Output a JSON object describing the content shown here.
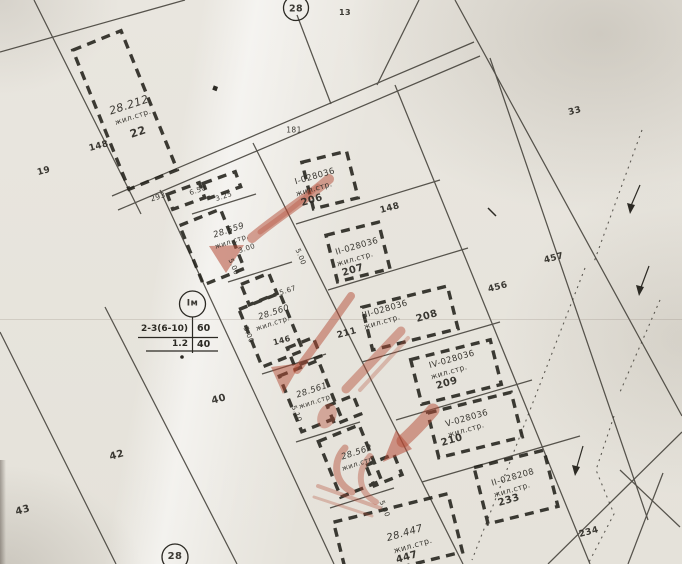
{
  "map": {
    "title_hint": "cadastral regulation plan sheet",
    "block_circle_top": "28",
    "block_circle_bottom": "28",
    "zone_box": {
      "zone": "Iм",
      "row1_left": "2-3(6-10)",
      "row1_right": "60",
      "row2_left": "1.2",
      "row2_right": "40"
    },
    "colors": {
      "paper": "#e9e6df",
      "ink": "#2c2a24",
      "red_marker": "#b44b36"
    },
    "labels": [
      {
        "n": "block-13",
        "t": "13",
        "x": 345,
        "y": 13,
        "r": 0,
        "s": 8,
        "b": true
      },
      {
        "n": "28-212",
        "t": "28.212",
        "x": 129,
        "y": 105,
        "r": -18,
        "s": 11,
        "i": true
      },
      {
        "n": "28-212-type",
        "t": "жил.стр.",
        "x": 133,
        "y": 117,
        "r": -18,
        "s": 7.5
      },
      {
        "n": "22",
        "t": "22",
        "x": 138,
        "y": 132,
        "r": -18,
        "s": 11,
        "b": true
      },
      {
        "n": "148-left",
        "t": "148",
        "x": 99,
        "y": 147,
        "r": -15,
        "s": 9,
        "b": true
      },
      {
        "n": "19",
        "t": "19",
        "x": 44,
        "y": 172,
        "r": -15,
        "s": 9,
        "b": true
      },
      {
        "n": "293",
        "t": "293",
        "x": 158,
        "y": 197,
        "r": -18,
        "s": 7.5
      },
      {
        "n": "dim-650",
        "t": "6.50",
        "x": 198,
        "y": 191,
        "r": -18,
        "s": 7
      },
      {
        "n": "dim-325",
        "t": "3.25",
        "x": 224,
        "y": 197,
        "r": -18,
        "s": 7
      },
      {
        "n": "181",
        "t": "181",
        "x": 294,
        "y": 130,
        "r": 0,
        "s": 7.5
      },
      {
        "n": "i-028036",
        "t": "I-028036",
        "x": 315,
        "y": 177,
        "r": -16,
        "s": 8.5
      },
      {
        "n": "i-028036-type",
        "t": "жил.стр.",
        "x": 314,
        "y": 189,
        "r": -16,
        "s": 7.5
      },
      {
        "n": "206",
        "t": "206",
        "x": 312,
        "y": 201,
        "r": -16,
        "s": 10,
        "b": true
      },
      {
        "n": "148-right",
        "t": "148",
        "x": 390,
        "y": 209,
        "r": -15,
        "s": 9,
        "b": true
      },
      {
        "n": "ii-028036",
        "t": "II-028036",
        "x": 357,
        "y": 247,
        "r": -16,
        "s": 8.5
      },
      {
        "n": "ii-028036-type",
        "t": "жил.стр.",
        "x": 355,
        "y": 259,
        "r": -16,
        "s": 7.5
      },
      {
        "n": "207",
        "t": "207",
        "x": 353,
        "y": 271,
        "r": -16,
        "s": 10,
        "b": true
      },
      {
        "n": "iii-028036",
        "t": "III-028036",
        "x": 385,
        "y": 310,
        "r": -16,
        "s": 8.5
      },
      {
        "n": "iii-028036-type",
        "t": "жил.стр.",
        "x": 382,
        "y": 322,
        "r": -16,
        "s": 7.5
      },
      {
        "n": "208",
        "t": "208",
        "x": 427,
        "y": 317,
        "r": -16,
        "s": 10,
        "b": true
      },
      {
        "n": "iv-028036",
        "t": "IV-028036",
        "x": 452,
        "y": 360,
        "r": -16,
        "s": 8.5
      },
      {
        "n": "iv-028036-type",
        "t": "жил.стр.",
        "x": 449,
        "y": 372,
        "r": -16,
        "s": 7.5
      },
      {
        "n": "209",
        "t": "209",
        "x": 447,
        "y": 384,
        "r": -16,
        "s": 10,
        "b": true
      },
      {
        "n": "v-028036",
        "t": "V-028036",
        "x": 467,
        "y": 419,
        "r": -16,
        "s": 8.5
      },
      {
        "n": "v-028036-type",
        "t": "жил.стр.",
        "x": 466,
        "y": 430,
        "r": -16,
        "s": 7.5
      },
      {
        "n": "210",
        "t": "210",
        "x": 452,
        "y": 441,
        "r": -16,
        "s": 10,
        "b": true
      },
      {
        "n": "ii-028208",
        "t": "II-028208",
        "x": 513,
        "y": 478,
        "r": -16,
        "s": 8.5
      },
      {
        "n": "ii-028208-type",
        "t": "жил.стр.",
        "x": 512,
        "y": 490,
        "r": -16,
        "s": 7.5
      },
      {
        "n": "233",
        "t": "233",
        "x": 509,
        "y": 501,
        "r": -16,
        "s": 10,
        "b": true
      },
      {
        "n": "28-447",
        "t": "28.447",
        "x": 405,
        "y": 534,
        "r": -16,
        "s": 10,
        "i": true
      },
      {
        "n": "28-447-type",
        "t": "жил.стр.",
        "x": 413,
        "y": 546,
        "r": -16,
        "s": 8
      },
      {
        "n": "447",
        "t": "447",
        "x": 407,
        "y": 558,
        "r": -16,
        "s": 10,
        "b": true
      },
      {
        "n": "28-559",
        "t": "28.559",
        "x": 229,
        "y": 231,
        "r": -18,
        "s": 8.5,
        "i": true
      },
      {
        "n": "28-559-type",
        "t": "жил.стр.",
        "x": 232,
        "y": 242,
        "r": -18,
        "s": 7
      },
      {
        "n": "28-560",
        "t": "28.560",
        "x": 274,
        "y": 313,
        "r": -18,
        "s": 8.5,
        "i": true
      },
      {
        "n": "28-560-type",
        "t": "жил.стр.",
        "x": 273,
        "y": 324,
        "r": -18,
        "s": 7
      },
      {
        "n": "28-561",
        "t": "28.561",
        "x": 312,
        "y": 391,
        "r": -18,
        "s": 8.5,
        "i": true
      },
      {
        "n": "28-561-type",
        "t": "жил.стр.",
        "x": 316,
        "y": 402,
        "r": -18,
        "s": 7
      },
      {
        "n": "28-562",
        "t": "28.562",
        "x": 357,
        "y": 453,
        "r": -18,
        "s": 8.5,
        "i": true
      },
      {
        "n": "28-562-type",
        "t": "жил.стр.",
        "x": 359,
        "y": 464,
        "r": -18,
        "s": 7
      },
      {
        "n": "211",
        "t": "211",
        "x": 347,
        "y": 334,
        "r": -15,
        "s": 9,
        "b": true
      },
      {
        "n": "146",
        "t": "146",
        "x": 282,
        "y": 341,
        "r": -15,
        "s": 8,
        "b": true
      },
      {
        "n": "40",
        "t": "40",
        "x": 219,
        "y": 400,
        "r": -15,
        "s": 10,
        "b": true
      },
      {
        "n": "42",
        "t": "42",
        "x": 117,
        "y": 456,
        "r": -15,
        "s": 10,
        "b": true
      },
      {
        "n": "43",
        "t": "43",
        "x": 23,
        "y": 511,
        "r": -15,
        "s": 10,
        "b": true
      },
      {
        "n": "33",
        "t": "33",
        "x": 575,
        "y": 112,
        "r": -15,
        "s": 9,
        "b": true
      },
      {
        "n": "457",
        "t": "457",
        "x": 554,
        "y": 259,
        "r": -15,
        "s": 9,
        "b": true
      },
      {
        "n": "456",
        "t": "456",
        "x": 498,
        "y": 288,
        "r": -15,
        "s": 9,
        "b": true
      },
      {
        "n": "234",
        "t": "234",
        "x": 589,
        "y": 533,
        "r": -15,
        "s": 9,
        "b": true
      },
      {
        "n": "dim-567",
        "t": "5.67",
        "x": 288,
        "y": 291,
        "r": -18,
        "s": 7
      },
      {
        "n": "dim-500-a",
        "t": "5.00",
        "x": 300,
        "y": 257,
        "r": 68,
        "s": 7
      },
      {
        "n": "dim-500-b",
        "t": "5.00",
        "x": 233,
        "y": 267,
        "r": 68,
        "s": 7
      },
      {
        "n": "dim-500-c",
        "t": "5.00",
        "x": 248,
        "y": 335,
        "r": 68,
        "s": 7
      },
      {
        "n": "dim-510",
        "t": "5.10",
        "x": 296,
        "y": 414,
        "r": 68,
        "s": 7
      },
      {
        "n": "dim-500-d",
        "t": "5.00",
        "x": 384,
        "y": 509,
        "r": 68,
        "s": 7
      },
      {
        "n": "dim-300",
        "t": "3.00",
        "x": 247,
        "y": 249,
        "r": -18,
        "s": 7
      }
    ],
    "buildings": [
      {
        "n": "28-212",
        "cx": 125,
        "cy": 110,
        "w": 52,
        "h": 150,
        "rot": -22
      },
      {
        "n": "206",
        "cx": 330,
        "cy": 180,
        "w": 46,
        "h": 48,
        "rot": -14
      },
      {
        "n": "207",
        "cx": 358,
        "cy": 252,
        "w": 54,
        "h": 48,
        "rot": -14
      },
      {
        "n": "208",
        "cx": 410,
        "cy": 318,
        "w": 88,
        "h": 44,
        "rot": -14
      },
      {
        "n": "209",
        "cx": 456,
        "cy": 372,
        "w": 82,
        "h": 46,
        "rot": -14
      },
      {
        "n": "210",
        "cx": 475,
        "cy": 425,
        "w": 86,
        "h": 46,
        "rot": -14
      },
      {
        "n": "233",
        "cx": 516,
        "cy": 487,
        "w": 72,
        "h": 58,
        "rot": -14
      },
      {
        "n": "447",
        "cx": 398,
        "cy": 537,
        "w": 118,
        "h": 60,
        "rot": -14
      },
      {
        "n": "559",
        "cx": 212,
        "cy": 247,
        "w": 44,
        "h": 64,
        "rot": -22
      },
      {
        "n": "560",
        "cx": 271,
        "cy": 330,
        "w": 44,
        "h": 62,
        "rot": -22
      },
      {
        "n": "561",
        "cx": 310,
        "cy": 396,
        "w": 42,
        "h": 60,
        "rot": -22
      },
      {
        "n": "562",
        "cx": 350,
        "cy": 461,
        "w": 44,
        "h": 60,
        "rot": -22
      },
      {
        "n": "garage-1",
        "cx": 259,
        "cy": 289,
        "w": 30,
        "h": 22,
        "rot": -22
      },
      {
        "n": "garage-2",
        "cx": 304,
        "cy": 352,
        "w": 28,
        "h": 20,
        "rot": -22
      },
      {
        "n": "garage-3",
        "cx": 344,
        "cy": 410,
        "w": 28,
        "h": 20,
        "rot": -22
      },
      {
        "n": "garage-4",
        "cx": 384,
        "cy": 470,
        "w": 30,
        "h": 22,
        "rot": -22
      },
      {
        "n": "shed-1",
        "cx": 186,
        "cy": 196,
        "w": 34,
        "h": 16,
        "rot": -20
      },
      {
        "n": "shed-2",
        "cx": 222,
        "cy": 185,
        "w": 34,
        "h": 16,
        "rot": -20
      }
    ]
  }
}
